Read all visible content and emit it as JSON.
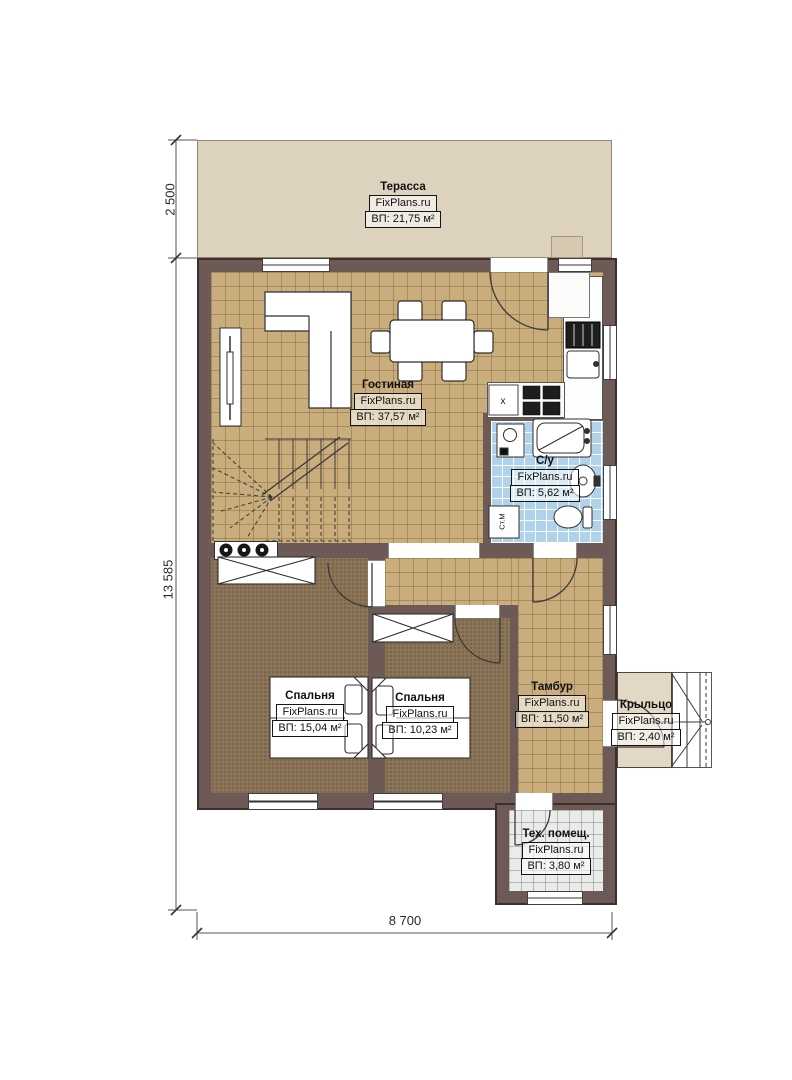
{
  "plan_title": "Floor plan — first floor",
  "brandmark": "FixPlans.ru",
  "rooms": [
    {
      "id": "terrace",
      "name": "Терасса",
      "brand": "FixPlans.ru",
      "area": "ВП: 21,75 м²"
    },
    {
      "id": "living",
      "name": "Гостиная",
      "brand": "FixPlans.ru",
      "area": "ВП: 37,57 м²"
    },
    {
      "id": "bathroom",
      "name": "С/у",
      "brand": "FixPlans.ru",
      "area": "ВП: 5,62 м²"
    },
    {
      "id": "bedroom1",
      "name": "Спальня",
      "brand": "FixPlans.ru",
      "area": "ВП: 15,04 м²"
    },
    {
      "id": "bedroom2",
      "name": "Спальня",
      "brand": "FixPlans.ru",
      "area": "ВП: 10,23 м²"
    },
    {
      "id": "tambur",
      "name": "Тамбур",
      "brand": "FixPlans.ru",
      "area": "ВП: 11,50 м²"
    },
    {
      "id": "porch",
      "name": "Крыльцо",
      "brand": "FixPlans.ru",
      "area": "ВП: 2,40 м²"
    },
    {
      "id": "tech",
      "name": "Тех. помещ.",
      "brand": "FixPlans.ru",
      "area": "ВП: 3,80 м²"
    }
  ],
  "dimensions": {
    "terrace_depth": "2 500",
    "total_depth": "13 585",
    "total_width": "8 700"
  },
  "annotations": {
    "washing_machine": "Ст.М",
    "sink_mark": "x"
  },
  "colors": {
    "wall": "#6d5a57",
    "tile_floor": "#c9ad7d",
    "bedroom_floor": "#8c7558",
    "bathroom_tile": "#b0d2ea",
    "terrace": "#dcd2be",
    "porch": "#e3d8c5",
    "tech_floor": "#ebebe9"
  }
}
